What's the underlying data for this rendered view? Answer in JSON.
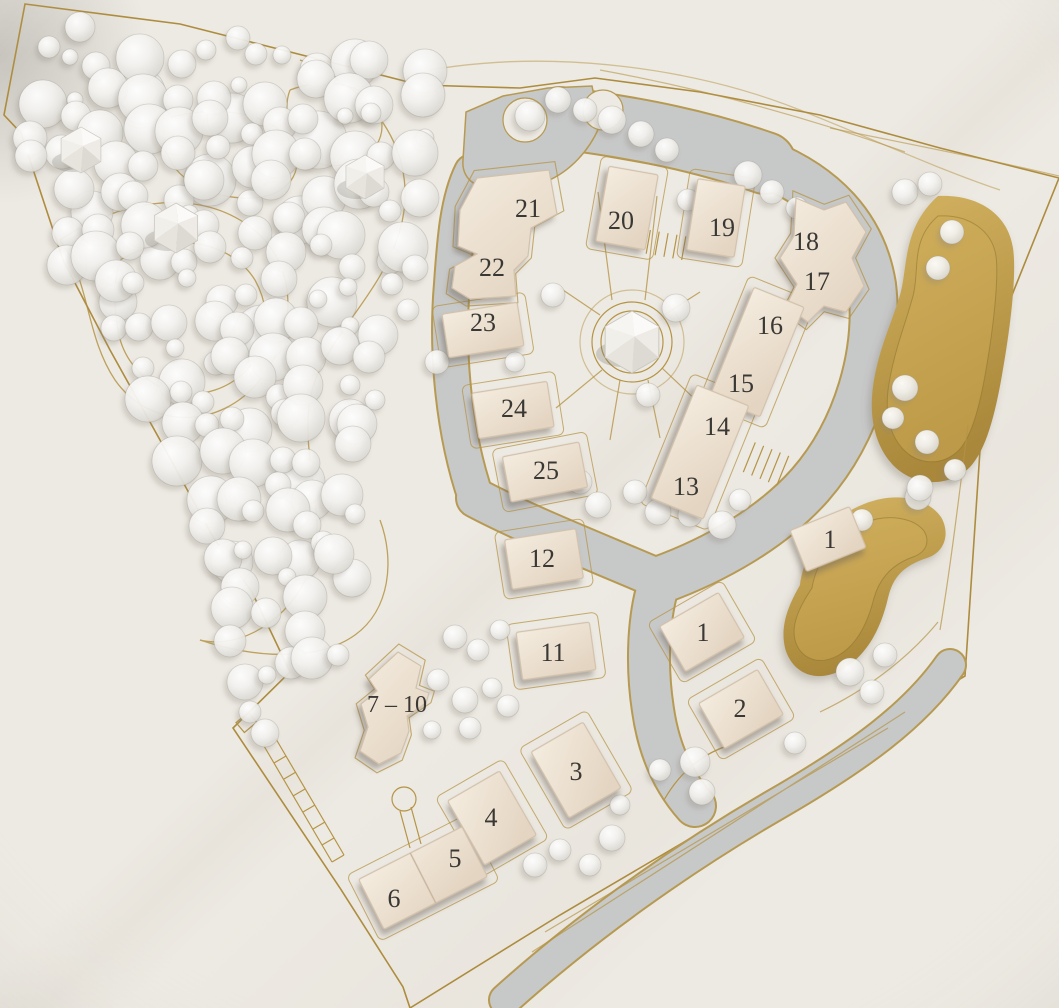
{
  "palette": {
    "base": "#edeae3",
    "road": "#c7c8c8",
    "gold_line": "#b59445",
    "gold_terrain": "#c7a44e",
    "building": "#eee3d3",
    "label_text": "#3a3834",
    "tree_glass": "#f3f2ef"
  },
  "buildings": [
    {
      "id": "building-21",
      "label": "21"
    },
    {
      "id": "building-22",
      "label": "22"
    },
    {
      "id": "building-23",
      "label": "23"
    },
    {
      "id": "building-20",
      "label": "20"
    },
    {
      "id": "building-19",
      "label": "19"
    },
    {
      "id": "building-18",
      "label": "18"
    },
    {
      "id": "building-17",
      "label": "17"
    },
    {
      "id": "building-16",
      "label": "16"
    },
    {
      "id": "building-15",
      "label": "15"
    },
    {
      "id": "building-14",
      "label": "14"
    },
    {
      "id": "building-13",
      "label": "13"
    },
    {
      "id": "building-24",
      "label": "24"
    },
    {
      "id": "building-25",
      "label": "25"
    },
    {
      "id": "building-12",
      "label": "12"
    },
    {
      "id": "building-11",
      "label": "11"
    },
    {
      "id": "building-1-east",
      "label": "1"
    },
    {
      "id": "building-1-south",
      "label": "1"
    },
    {
      "id": "building-2",
      "label": "2"
    },
    {
      "id": "building-7-10",
      "label": "7 – 10"
    },
    {
      "id": "building-3",
      "label": "3"
    },
    {
      "id": "building-4",
      "label": "4"
    },
    {
      "id": "building-5",
      "label": "5"
    },
    {
      "id": "building-6",
      "label": "6"
    }
  ]
}
